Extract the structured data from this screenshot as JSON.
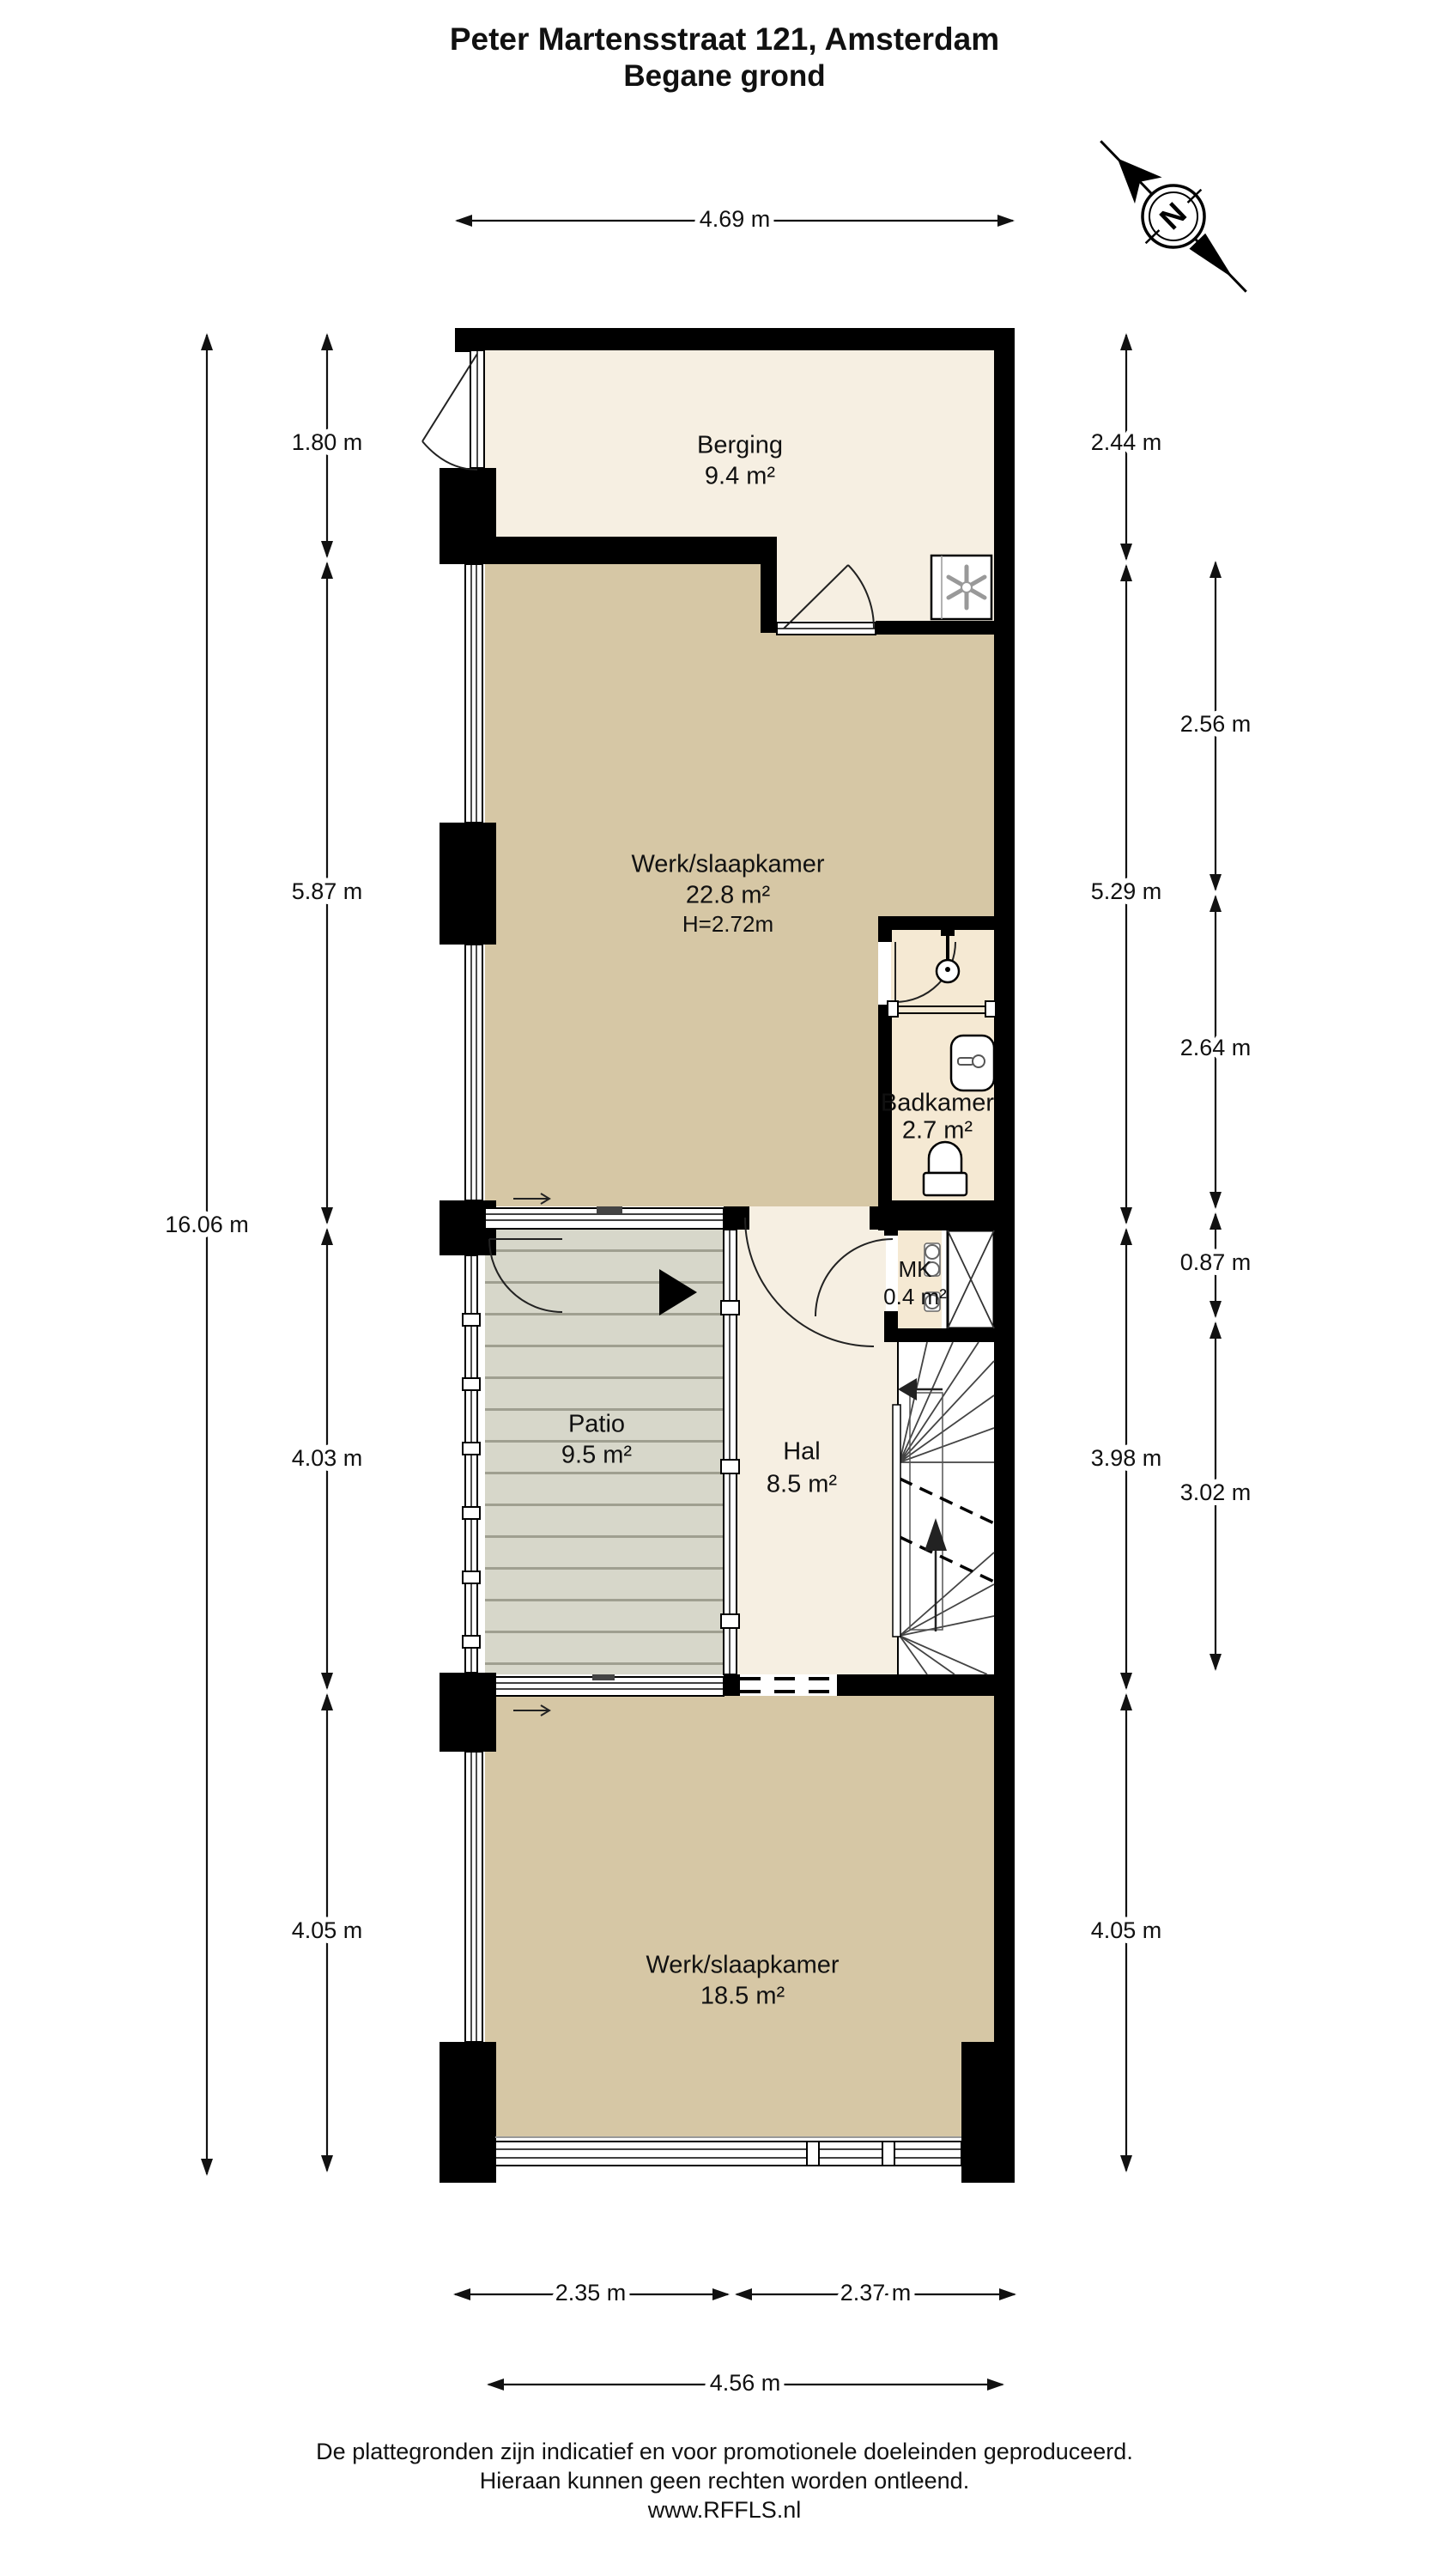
{
  "title": {
    "line1": "Peter Martensstraat 121, Amsterdam",
    "line2": "Begane grond"
  },
  "compass": {
    "label": "N"
  },
  "rooms": {
    "berging": {
      "name": "Berging",
      "area": "9.4 m²"
    },
    "werkkamer_boven": {
      "name": "Werk/slaapkamer",
      "area": "22.8 m²",
      "ceiling": "H=2.72m"
    },
    "badkamer": {
      "name": "Badkamer",
      "area": "2.7 m²"
    },
    "mk": {
      "name": "MK",
      "area": "0.4 m²"
    },
    "patio": {
      "name": "Patio",
      "area": "9.5 m²"
    },
    "hal": {
      "name": "Hal",
      "area": "8.5 m²"
    },
    "werkkamer_onder": {
      "name": "Werk/slaapkamer",
      "area": "18.5 m²"
    }
  },
  "dimensions": {
    "top_total": "4.69 m",
    "left_total": "16.06 m",
    "left_segments": [
      "1.80 m",
      "5.87 m",
      "4.03 m",
      "4.05 m"
    ],
    "right_inner": [
      "2.44 m",
      "5.29 m",
      "3.98 m",
      "4.05 m"
    ],
    "right_outer": [
      "2.56 m",
      "2.64 m",
      "0.87 m",
      "3.02 m"
    ],
    "bottom_segments": [
      "2.35 m",
      "2.37 m"
    ],
    "bottom_total": "4.56 m"
  },
  "footer": {
    "line1": "De plattegronden zijn indicatief en voor promotionele doeleinden geproduceerd.",
    "line2": "Hieraan kunnen geen rechten worden ontleend.",
    "line3": "www.RFFLS.nl"
  },
  "colors": {
    "wall": "#000000",
    "floor_cream": "#f6efe2",
    "floor_tan": "#d6c7a5",
    "floor_bath": "#f5e9d3",
    "patio": "#d7d7ca",
    "patio_stripe": "#9f9f90"
  }
}
